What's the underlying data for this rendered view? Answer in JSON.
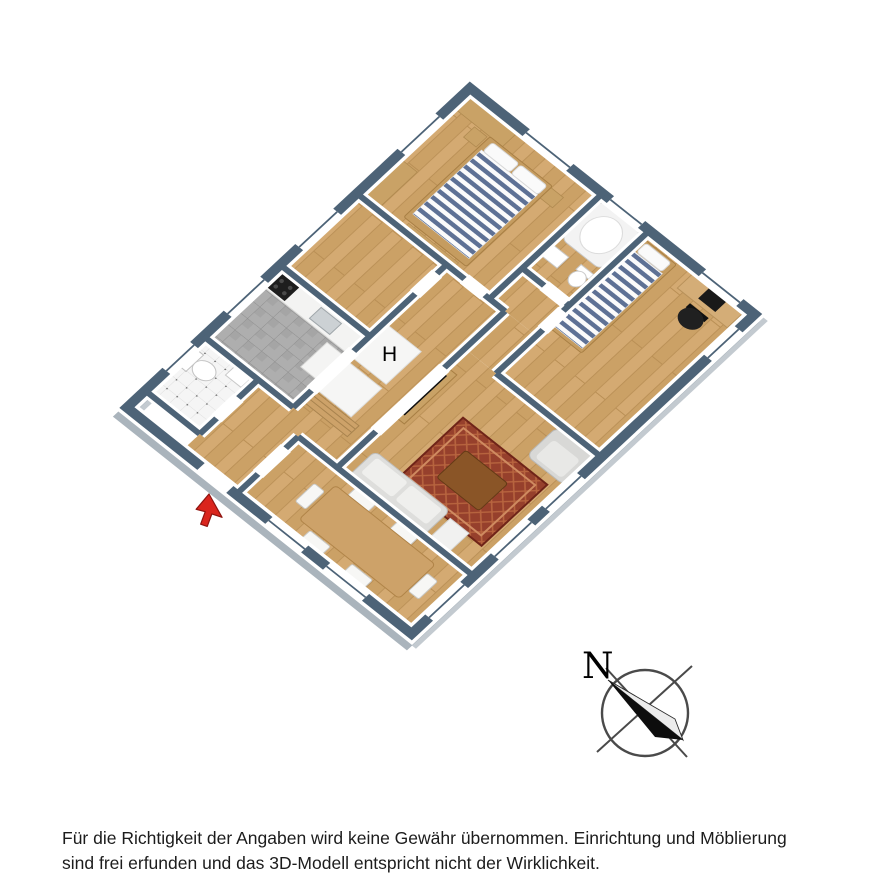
{
  "plan": {
    "hall_label": "H"
  },
  "compass": {
    "north_label": "N"
  },
  "disclaimer": {
    "line1": "Für die Richtigkeit der Angaben wird keine Gewähr übernommen. Einrichtung und Möblierung",
    "line2": "sind frei erfunden und das 3D-Modell entspricht nicht der Wirklichkeit."
  },
  "palette": {
    "wall_cap": "#4d6377",
    "wall_face_shadow": "#b3bcc3",
    "floor_wood": "#d4aa72",
    "kitchen_tile": "#aeaeae",
    "wc_tile": "#f5f5f5",
    "mattress_stripe": "#5e7195",
    "rug_red": "#96402c",
    "furniture_wood": "#c9a266",
    "entrance_arrow_red": "#da251d"
  }
}
